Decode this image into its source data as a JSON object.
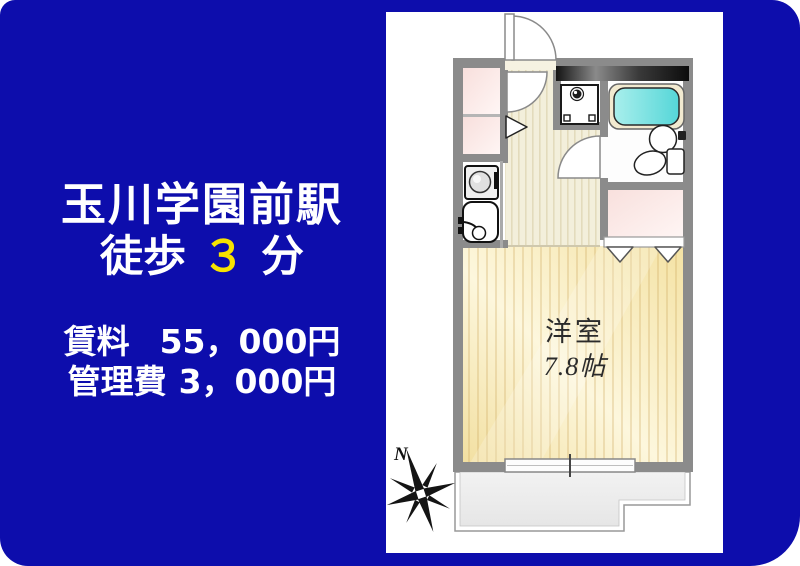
{
  "background": {
    "blue": "#0d0dac"
  },
  "ad_text": {
    "station": "玉川学園前駅",
    "walk_prefix": "徒歩",
    "walk_minutes": "３",
    "walk_suffix": "分",
    "rent_label": "賃料",
    "rent_value": "55，000円",
    "management_label": "管理費",
    "management_value": "3，000円",
    "text_color": "#ffffff",
    "highlight_color": "#f7e300"
  },
  "floorplan": {
    "room_label": "洋室",
    "room_size": "7.8帖",
    "compass_label": "N",
    "colors": {
      "wall": "#8b8b8b",
      "bathtub": "#5fd8da",
      "room_floor": "#f6e6ac",
      "hall_floor": "#f3efdb",
      "closet": "#f8dfdc",
      "balcony": "#ededed",
      "dark_wall_bar": "#141414"
    },
    "features": [
      "entrance-door",
      "washing-machine",
      "bathtub",
      "wash-basin",
      "toilet",
      "kitchen-stove",
      "kitchen-sink",
      "closets",
      "bi-fold-closet-door",
      "sliding-window",
      "balcony",
      "compass-rose"
    ]
  }
}
